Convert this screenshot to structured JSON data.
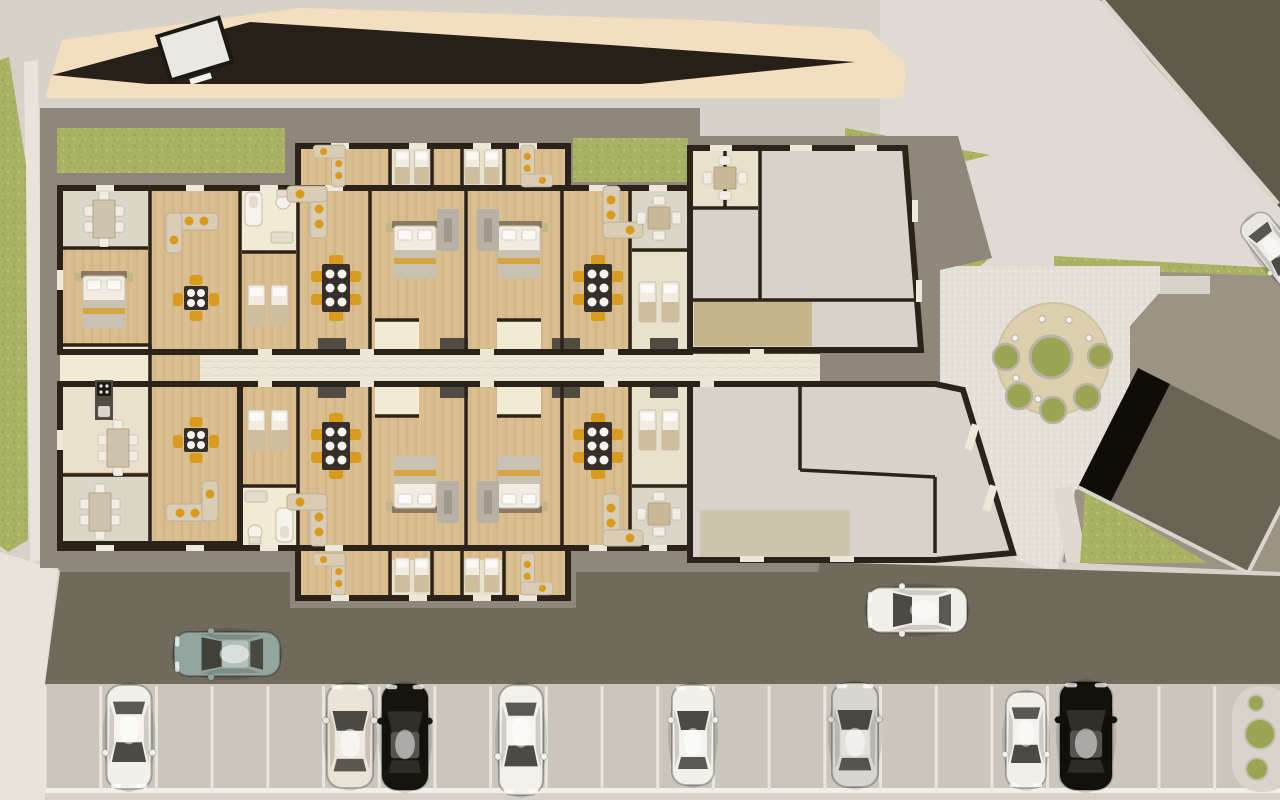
{
  "scene": {
    "kind": "architectural-site-plan",
    "description": "Top-down rendered site plan of an apartment building with furnished units, unfurnished wing, gravel plaza with round patio, annex building, access road and parking lot"
  },
  "colors": {
    "bg": "#d7d2c9",
    "bglight": "#dfdbd4",
    "path": "#e8e4dc",
    "beige": "#f3dfc0",
    "road": "#262019",
    "corner": "#5f5a4c",
    "drive": "#6e6a5c",
    "taupe": "#9c9385",
    "apron": "#8f877b",
    "grass": "#aab263",
    "gravel": "#e4e0d8",
    "sand": "#dbcfad",
    "bush": "#9aa654",
    "wall": "#2b2319",
    "wood": "#d9bd8e",
    "cream": "#eae1cd",
    "balcony": "#dcd6c9",
    "marble": "#ece6d7",
    "bath": "#f3ead3",
    "grayroom": "#d7d3cb",
    "tan": "#c3b489",
    "kitchen": "#514c42",
    "tabledark": "#362f27",
    "chair": "#d89b1e",
    "sofa": "#d9cdb5",
    "rug": "#b7b1a5",
    "stall": "#e9e6df",
    "parklot": "#cbc6bd",
    "slab": "#6a6456",
    "slabblack": "#100d08",
    "white": "#f2efe9"
  },
  "site": {
    "cars": [
      {
        "name": "sedan-teal-driveway",
        "color": "#93a59f",
        "x": 227,
        "y": 654,
        "rot": -90,
        "len": 106,
        "wid": 44
      },
      {
        "name": "sedan-white-driveway",
        "color": "#f1efe8",
        "x": 917,
        "y": 610,
        "rot": -90,
        "len": 100,
        "wid": 45
      },
      {
        "name": "car-edge-road",
        "color": "#e9e7e1",
        "x": 1276,
        "y": 252,
        "rot": 142,
        "len": 86,
        "wid": 34
      },
      {
        "name": "parked-white-1",
        "color": "#f2f0e9",
        "x": 129,
        "y": 737,
        "rot": 180,
        "len": 104,
        "wid": 45
      },
      {
        "name": "parked-champagne",
        "color": "#e9e4d8",
        "x": 350,
        "y": 736,
        "rot": 0,
        "len": 104,
        "wid": 46
      },
      {
        "name": "parked-black",
        "color": "#17130d",
        "x": 405,
        "y": 737,
        "rot": 0,
        "len": 106,
        "wid": 46
      },
      {
        "name": "parked-white-2",
        "color": "#f3f1ea",
        "x": 521,
        "y": 740,
        "rot": 180,
        "len": 110,
        "wid": 44
      },
      {
        "name": "parked-white-3",
        "color": "#f2f0e9",
        "x": 693,
        "y": 735,
        "rot": 0,
        "len": 100,
        "wid": 42
      },
      {
        "name": "parked-silver-van",
        "color": "#d9d6cf",
        "x": 855,
        "y": 735,
        "rot": 0,
        "len": 104,
        "wid": 46
      },
      {
        "name": "parked-white-small",
        "color": "#f1efe9",
        "x": 1026,
        "y": 740,
        "rot": 180,
        "len": 96,
        "wid": 40
      },
      {
        "name": "parked-black-suv",
        "color": "#14110b",
        "x": 1086,
        "y": 736,
        "rot": 0,
        "len": 108,
        "wid": 52
      }
    ],
    "parking": {
      "first_x": 45,
      "pitch": 55.7,
      "count": 22,
      "top": 686,
      "bottom": 790
    },
    "patio": {
      "cx": 1053,
      "cy": 359,
      "r": 56,
      "center_bush": {
        "x": 1051,
        "y": 357,
        "r": 21
      },
      "bushes": [
        {
          "x": 1006,
          "y": 357,
          "r": 13
        },
        {
          "x": 1100,
          "y": 356,
          "r": 12
        },
        {
          "x": 1019,
          "y": 396,
          "r": 13
        },
        {
          "x": 1087,
          "y": 397,
          "r": 13
        },
        {
          "x": 1053,
          "y": 410,
          "r": 13
        }
      ],
      "lights": [
        {
          "x": 1042,
          "y": 319
        },
        {
          "x": 1069,
          "y": 320
        },
        {
          "x": 1015,
          "y": 338
        },
        {
          "x": 1089,
          "y": 338
        },
        {
          "x": 1016,
          "y": 378
        },
        {
          "x": 1038,
          "y": 399
        }
      ]
    },
    "island_bushes": [
      {
        "x": 1256,
        "y": 703,
        "r": 8
      },
      {
        "x": 1260,
        "y": 734,
        "r": 15
      },
      {
        "x": 1257,
        "y": 769,
        "r": 11
      }
    ]
  }
}
